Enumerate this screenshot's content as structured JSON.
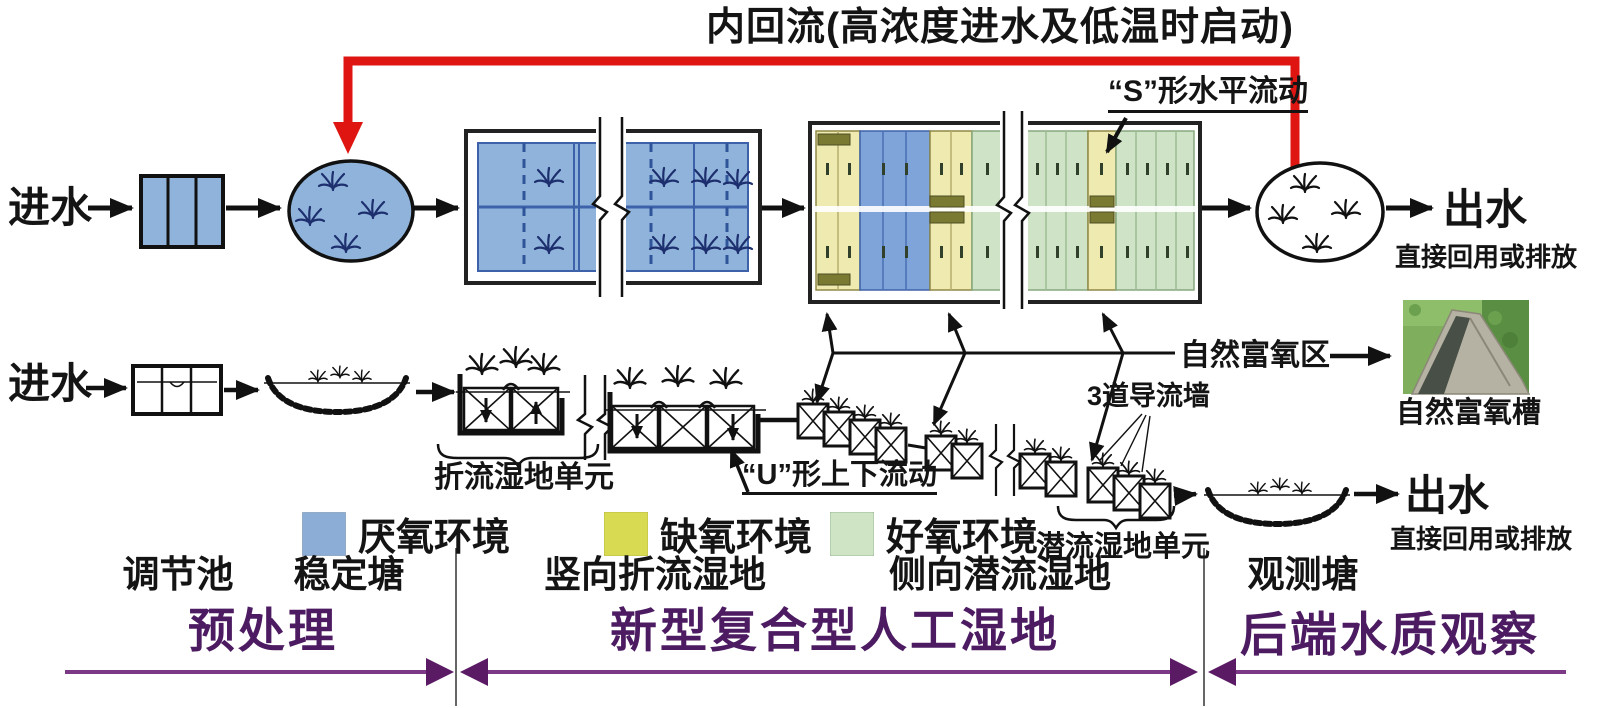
{
  "title": "内回流(高浓度进水及低温时启动)",
  "plan_view": {
    "inlet_label": "进水",
    "outlet_label": "出水",
    "outlet_note": "直接回用或排放",
    "s_flow_label": "“S”形水平流动"
  },
  "profile_view": {
    "inlet_label": "进水",
    "outlet_label": "出水",
    "outlet_note": "直接回用或排放",
    "baffle_unit_label": "折流湿地单元",
    "u_flow_label": "“U”形上下流动",
    "subsurface_unit_label": "潜流湿地单元",
    "guide_wall_label": "3道导流墙",
    "aeration_zone_label": "自然富氧区",
    "aeration_channel_caption": "自然富氧槽"
  },
  "legend": {
    "items": [
      {
        "name": "anaerobic",
        "label": "厌氧环境",
        "color": "#8badd6"
      },
      {
        "name": "anoxic",
        "label": "缺氧环境",
        "color": "#d8db52"
      },
      {
        "name": "aerobic",
        "label": "好氧环境",
        "color": "#cfe4c5"
      }
    ]
  },
  "unit_labels": {
    "regulating_tank": "调节池",
    "stabilization_pond": "稳定塘",
    "vertical_baffle_wetland": "竖向折流湿地",
    "lateral_subsurface_wetland": "侧向潜流湿地",
    "observation_pond": "观测塘"
  },
  "stages": {
    "pretreatment": "预处理",
    "composite_wetland": "新型复合型人工湿地",
    "backend_observation": "后端水质观察"
  },
  "colors": {
    "anaerobic_cell": "#7ea4d9",
    "anoxic_cell": "#efeab0",
    "aerobic_cell": "#cfe4c6",
    "recirculation_red": "#de1510",
    "stage_text_purple": "#4c1b61",
    "stage_line_purple": "#7c3a86"
  }
}
